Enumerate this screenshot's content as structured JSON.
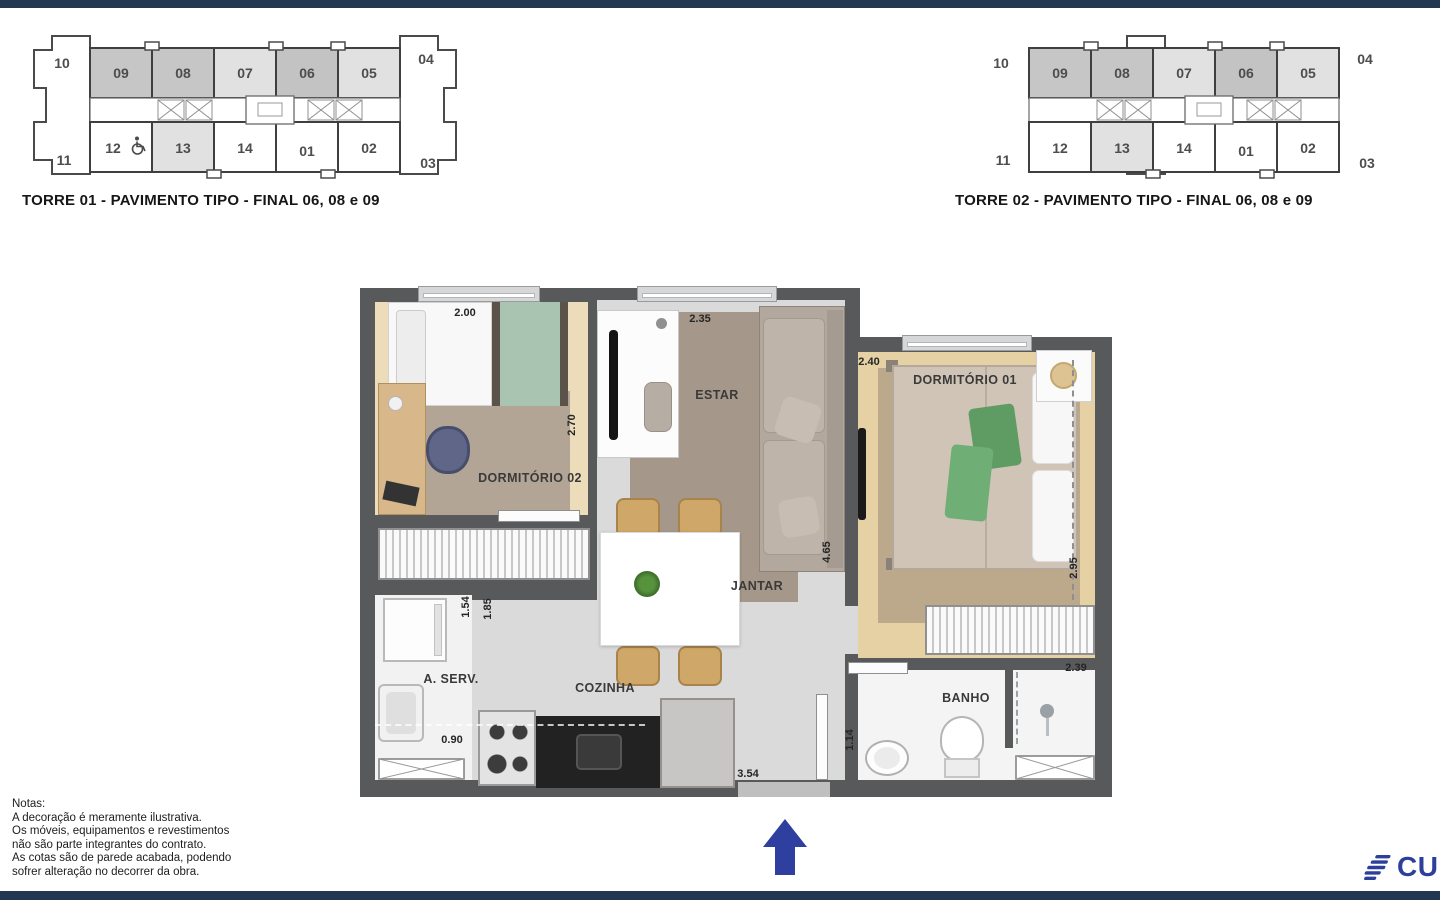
{
  "colors": {
    "navy": "#223850",
    "brand": "#2c3f9b",
    "wall": "#58595b"
  },
  "keyplans": [
    {
      "caption": "TORRE 01 - PAVIMENTO TIPO - FINAL 06, 08 e 09",
      "ends": {
        "left_top": "10",
        "left_bottom": "11",
        "right_top": "04",
        "right_bottom": "03"
      },
      "top_units": [
        {
          "label": "09",
          "fill": "#c6c6c6"
        },
        {
          "label": "08",
          "fill": "#c6c6c6"
        },
        {
          "label": "07",
          "fill": "#e1e1e1"
        },
        {
          "label": "06",
          "fill": "#c3c3c3"
        },
        {
          "label": "05",
          "fill": "#e1e1e1"
        }
      ],
      "bottom_units": [
        {
          "label": "12",
          "fill": "#ffffff"
        },
        {
          "label": "13",
          "fill": "#e1e1e1"
        },
        {
          "label": "14",
          "fill": "#ffffff"
        },
        {
          "label": "01",
          "fill": "#ffffff"
        },
        {
          "label": "02",
          "fill": "#ffffff"
        }
      ]
    },
    {
      "caption": "TORRE 02 - PAVIMENTO TIPO - FINAL 06, 08 e 09",
      "ends": {
        "left_top": "10",
        "left_bottom": "11",
        "right_top": "04",
        "right_bottom": "03"
      },
      "top_units": [
        {
          "label": "09",
          "fill": "#c6c6c6"
        },
        {
          "label": "08",
          "fill": "#c6c6c6"
        },
        {
          "label": "07",
          "fill": "#e1e1e1"
        },
        {
          "label": "06",
          "fill": "#c3c3c3"
        },
        {
          "label": "05",
          "fill": "#e1e1e1"
        }
      ],
      "bottom_units": [
        {
          "label": "12",
          "fill": "#ffffff"
        },
        {
          "label": "13",
          "fill": "#e1e1e1"
        },
        {
          "label": "14",
          "fill": "#ffffff"
        },
        {
          "label": "01",
          "fill": "#ffffff"
        },
        {
          "label": "02",
          "fill": "#ffffff"
        }
      ]
    }
  ],
  "plan": {
    "rooms": {
      "dormitorio2": "DORMITÓRIO 02",
      "dormitorio1": "DORMITÓRIO 01",
      "estar": "ESTAR",
      "jantar": "JANTAR",
      "cozinha": "COZINHA",
      "area_servico": "A. SERV.",
      "banho": "BANHO"
    },
    "dims": {
      "dorm2_width": "2.00",
      "estar_width": "2.35",
      "dorm1_width": "2.40",
      "dorm2_depth": "2.70",
      "sala_depth": "4.65",
      "dorm1_depth": "2.95",
      "aserv_w1": "1.54",
      "aserv_w2": "1.85",
      "aserv_depth": "0.90",
      "cozinha_width": "3.54",
      "banho_width": "1.14",
      "banho_depth": "2.39"
    }
  },
  "notes": {
    "title": "Notas:",
    "lines": [
      "A decoração é meramente ilustrativa.",
      "Os móveis, equipamentos e revestimentos",
      "não são parte integrantes do contrato.",
      "As cotas são de parede acabada, podendo",
      "sofrer alteração no decorrer da obra."
    ]
  },
  "logo": {
    "text": "CURY"
  }
}
